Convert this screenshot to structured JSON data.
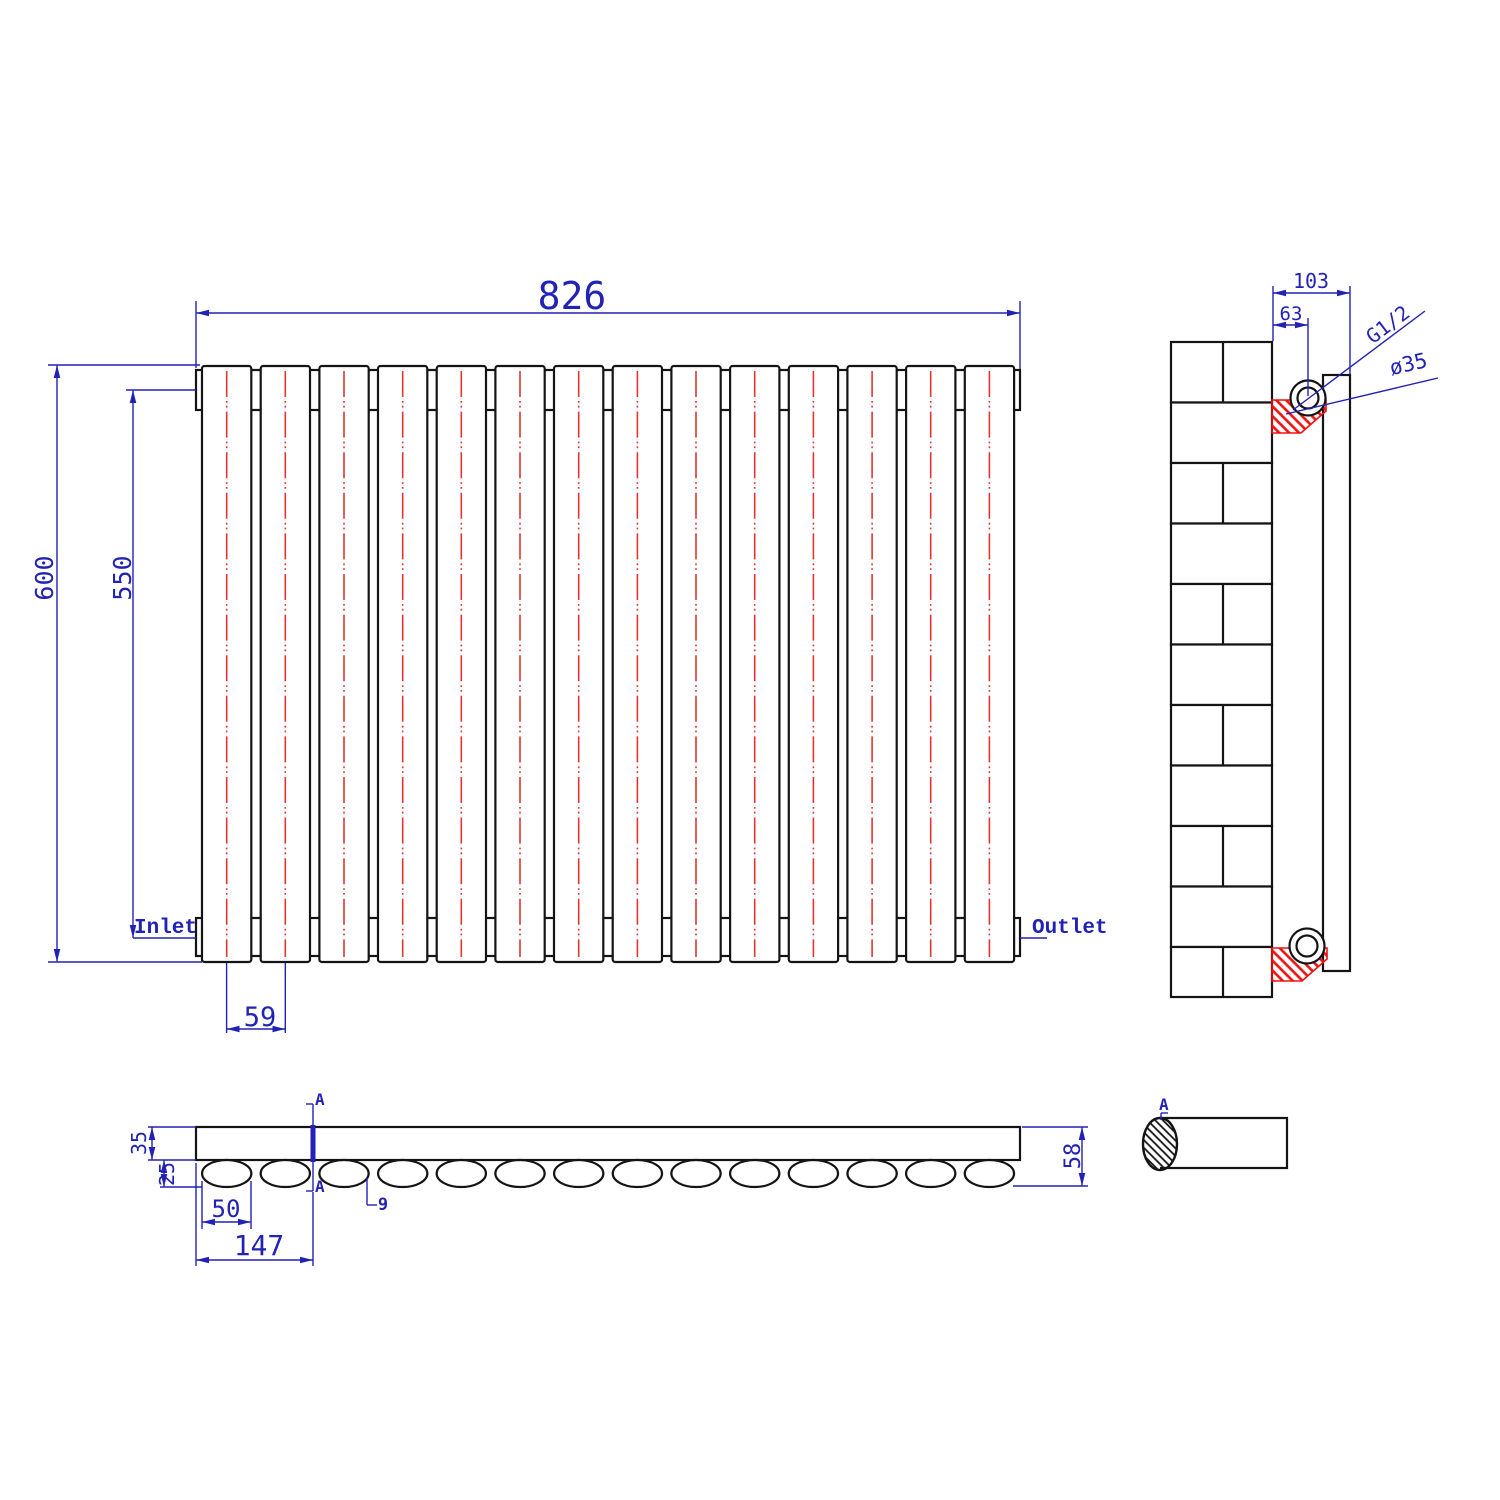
{
  "colors": {
    "dimension_blue": "#2222b4",
    "centerline_red": "#e03535",
    "bracket_red": "#ee1111",
    "outline_black": "#141414"
  },
  "front_view": {
    "panel_count": 14,
    "width_dim": "826",
    "height_dim": "600",
    "inner_height_dim": "550",
    "panel_pitch_dim": "59",
    "inlet_label": "Inlet",
    "outlet_label": "Outlet"
  },
  "side_view": {
    "brick_rows": 11,
    "depth_dim": "103",
    "pipe_center_dim": "63",
    "thread_label": "G1/2",
    "diameter_label": "ø35"
  },
  "bottom_view": {
    "oval_count": 14,
    "panel_thickness_dim": "35",
    "oval_height_dim": "25",
    "oval_width_dim": "50",
    "section_offset_dim": "147",
    "oval_gap_dim": "9",
    "total_depth_dim": "58",
    "section_mark_top": "A",
    "section_mark_bottom": "A"
  },
  "section_detail": {
    "mark": "A"
  }
}
